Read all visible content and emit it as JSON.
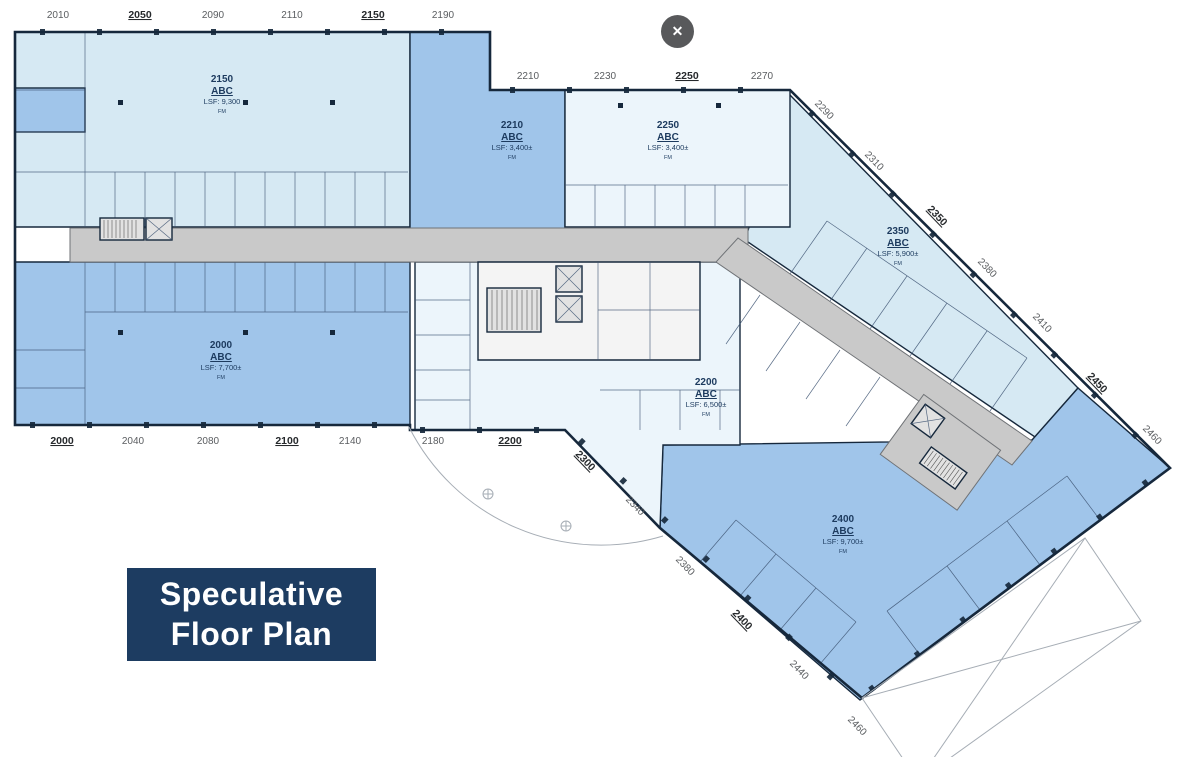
{
  "lightbox": {
    "close_glyph": "✕"
  },
  "badge": {
    "line1": "Speculative",
    "line2": "Floor Plan"
  },
  "suites": {
    "s2150": {
      "number": "2150",
      "tenant": "ABC",
      "area": "LSF: 9,300",
      "note": "FM"
    },
    "s2210": {
      "number": "2210",
      "tenant": "ABC",
      "area": "LSF: 3,400±",
      "note": "FM"
    },
    "s2250": {
      "number": "2250",
      "tenant": "ABC",
      "area": "LSF: 3,400±",
      "note": "FM"
    },
    "s2350": {
      "number": "2350",
      "tenant": "ABC",
      "area": "LSF: 5,900±",
      "note": "FM"
    },
    "s2000": {
      "number": "2000",
      "tenant": "ABC",
      "area": "LSF: 7,700±",
      "note": "FM"
    },
    "s2200": {
      "number": "2200",
      "tenant": "ABC",
      "area": "LSF: 6,500±",
      "note": "FM"
    },
    "s2400": {
      "number": "2400",
      "tenant": "ABC",
      "area": "LSF: 9,700±",
      "note": "FM"
    }
  },
  "dimensions": {
    "top": [
      "2010",
      "2050",
      "2090",
      "2110",
      "2150",
      "2190"
    ],
    "upper_mid": [
      "2210",
      "2230",
      "2250",
      "2270"
    ],
    "bottom": [
      "2000",
      "2040",
      "2080",
      "2100",
      "2140",
      "2180",
      "2200"
    ],
    "right_diagonal": [
      "2290",
      "2310",
      "2350",
      "2380",
      "2410",
      "2450",
      "2460"
    ],
    "lower_left_diagonal": [
      "2300",
      "2340"
    ],
    "bottom_diagonal": [
      "2380",
      "2400",
      "2440",
      "2460"
    ]
  },
  "colors": {
    "suite_pale": "#d6e9f3",
    "suite_palest": "#ecf5fb",
    "suite_medium": "#a0c5ea",
    "corridor": "#c9c9c9",
    "core_fill": "#f4f4f4",
    "hatch_fill": "#e2e2e2",
    "wall": "#16283c",
    "badge_bg": "#1d3c61",
    "badge_text": "#ffffff",
    "close_button_bg": "#58595b",
    "dim_text": "#5a5d60",
    "suite_text": "#1c3a5e"
  }
}
